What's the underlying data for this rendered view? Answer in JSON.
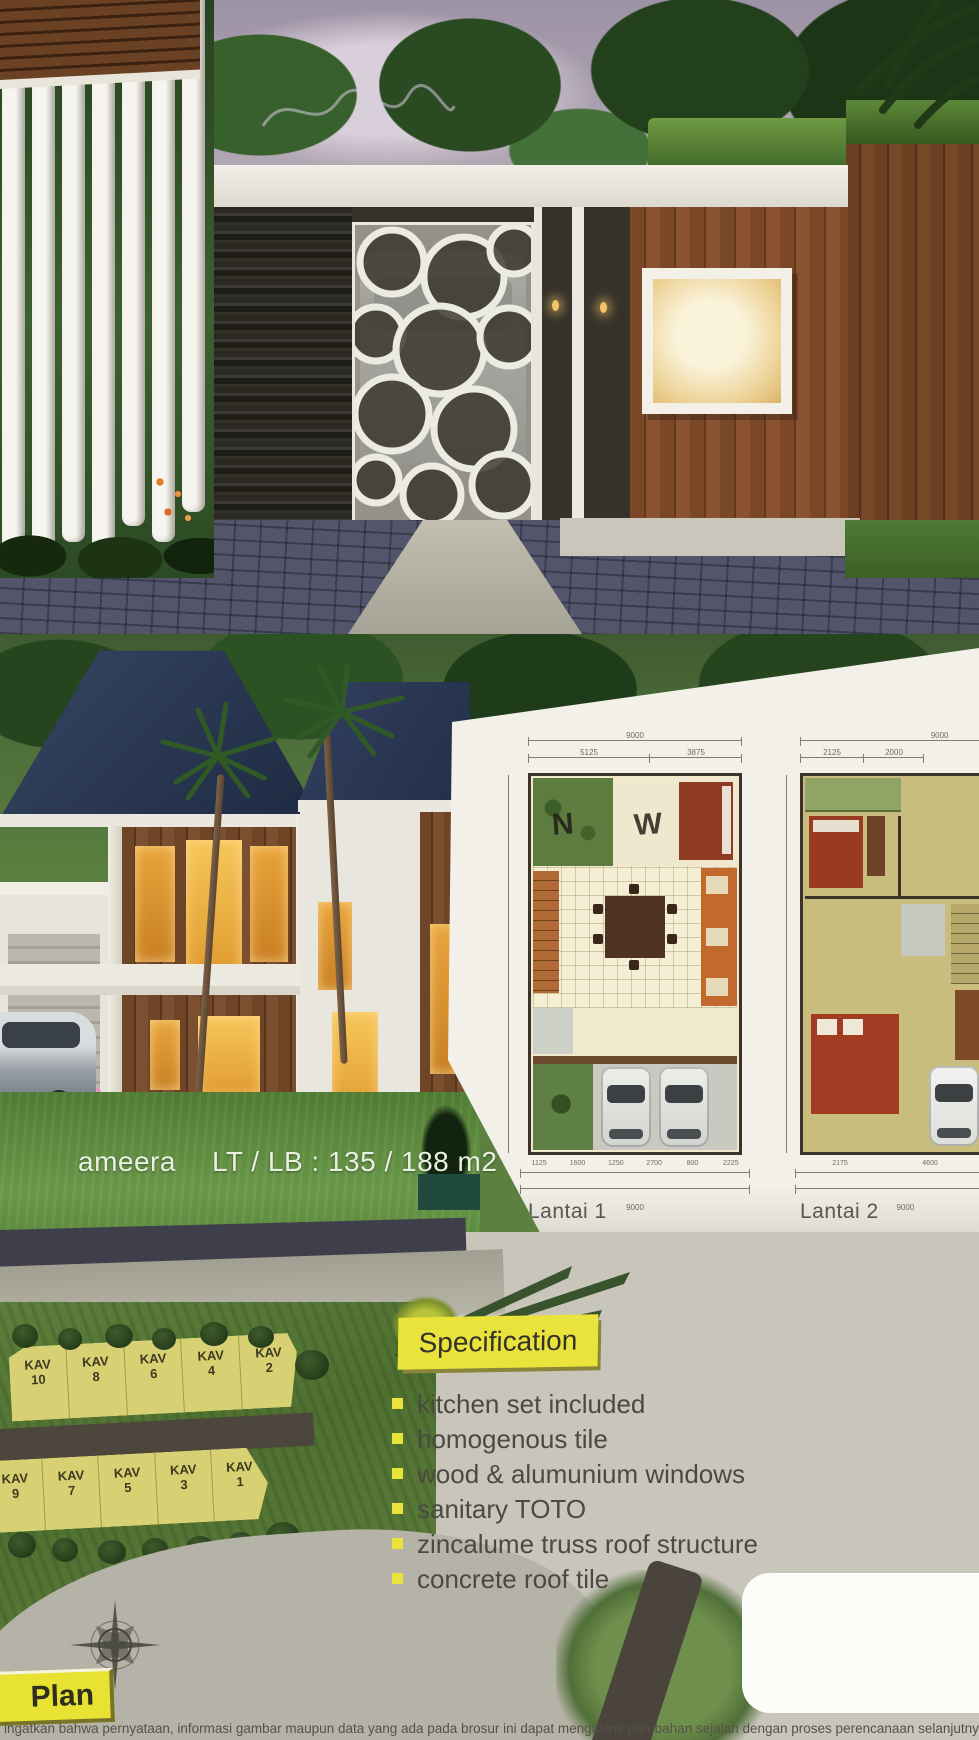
{
  "listing": {
    "name": "ameera",
    "size_label": "LT / LB : 135 / 188 m2"
  },
  "floorplan_panel": {
    "plan1": {
      "label": "Lantai 1",
      "dim_top_total": "9000",
      "dim_top_segments": [
        "5125",
        "3875"
      ],
      "dim_bottom_segments": [
        "1125",
        "1600",
        "1250",
        "2700",
        "800",
        "2225"
      ],
      "dim_bottom_total": "9000",
      "watermark_left": "N",
      "watermark_right": "W"
    },
    "plan2": {
      "label": "Lantai 2",
      "dim_top_total": "9000",
      "dim_top_segments": [
        "2125",
        "2000"
      ],
      "dim_bottom_segments": [
        "2175",
        "4600"
      ],
      "dim_bottom_total": "9000"
    }
  },
  "siteplan": {
    "lot_prefix": "KAV",
    "row1_numbers": [
      "10",
      "8",
      "6",
      "4",
      "2"
    ],
    "row2_numbers": [
      "9",
      "7",
      "5",
      "3",
      "1"
    ],
    "plan_label": "Plan"
  },
  "specification": {
    "title": "Specification",
    "items": [
      "kitchen set included",
      "homogenous tile",
      "wood & alumunium windows",
      "sanitary TOTO",
      "zincalume truss roof structure",
      "concrete roof tile"
    ]
  },
  "disclaimer": "ingatkan bahwa pernyataan, informasi gambar maupun data yang ada pada brosur ini dapat mengalami perubahan sejalan dengan proses perencanaan selanjutnya dan pelaksanaan",
  "colors": {
    "spec_yellow": "#E9E33B",
    "lot_yellow": "#D8D173",
    "roof_navy": "#2C3A55",
    "panel_cream": "#F1EFE8",
    "page_beige": "#C8C5BB",
    "grass_green": "#5D7F3C"
  }
}
